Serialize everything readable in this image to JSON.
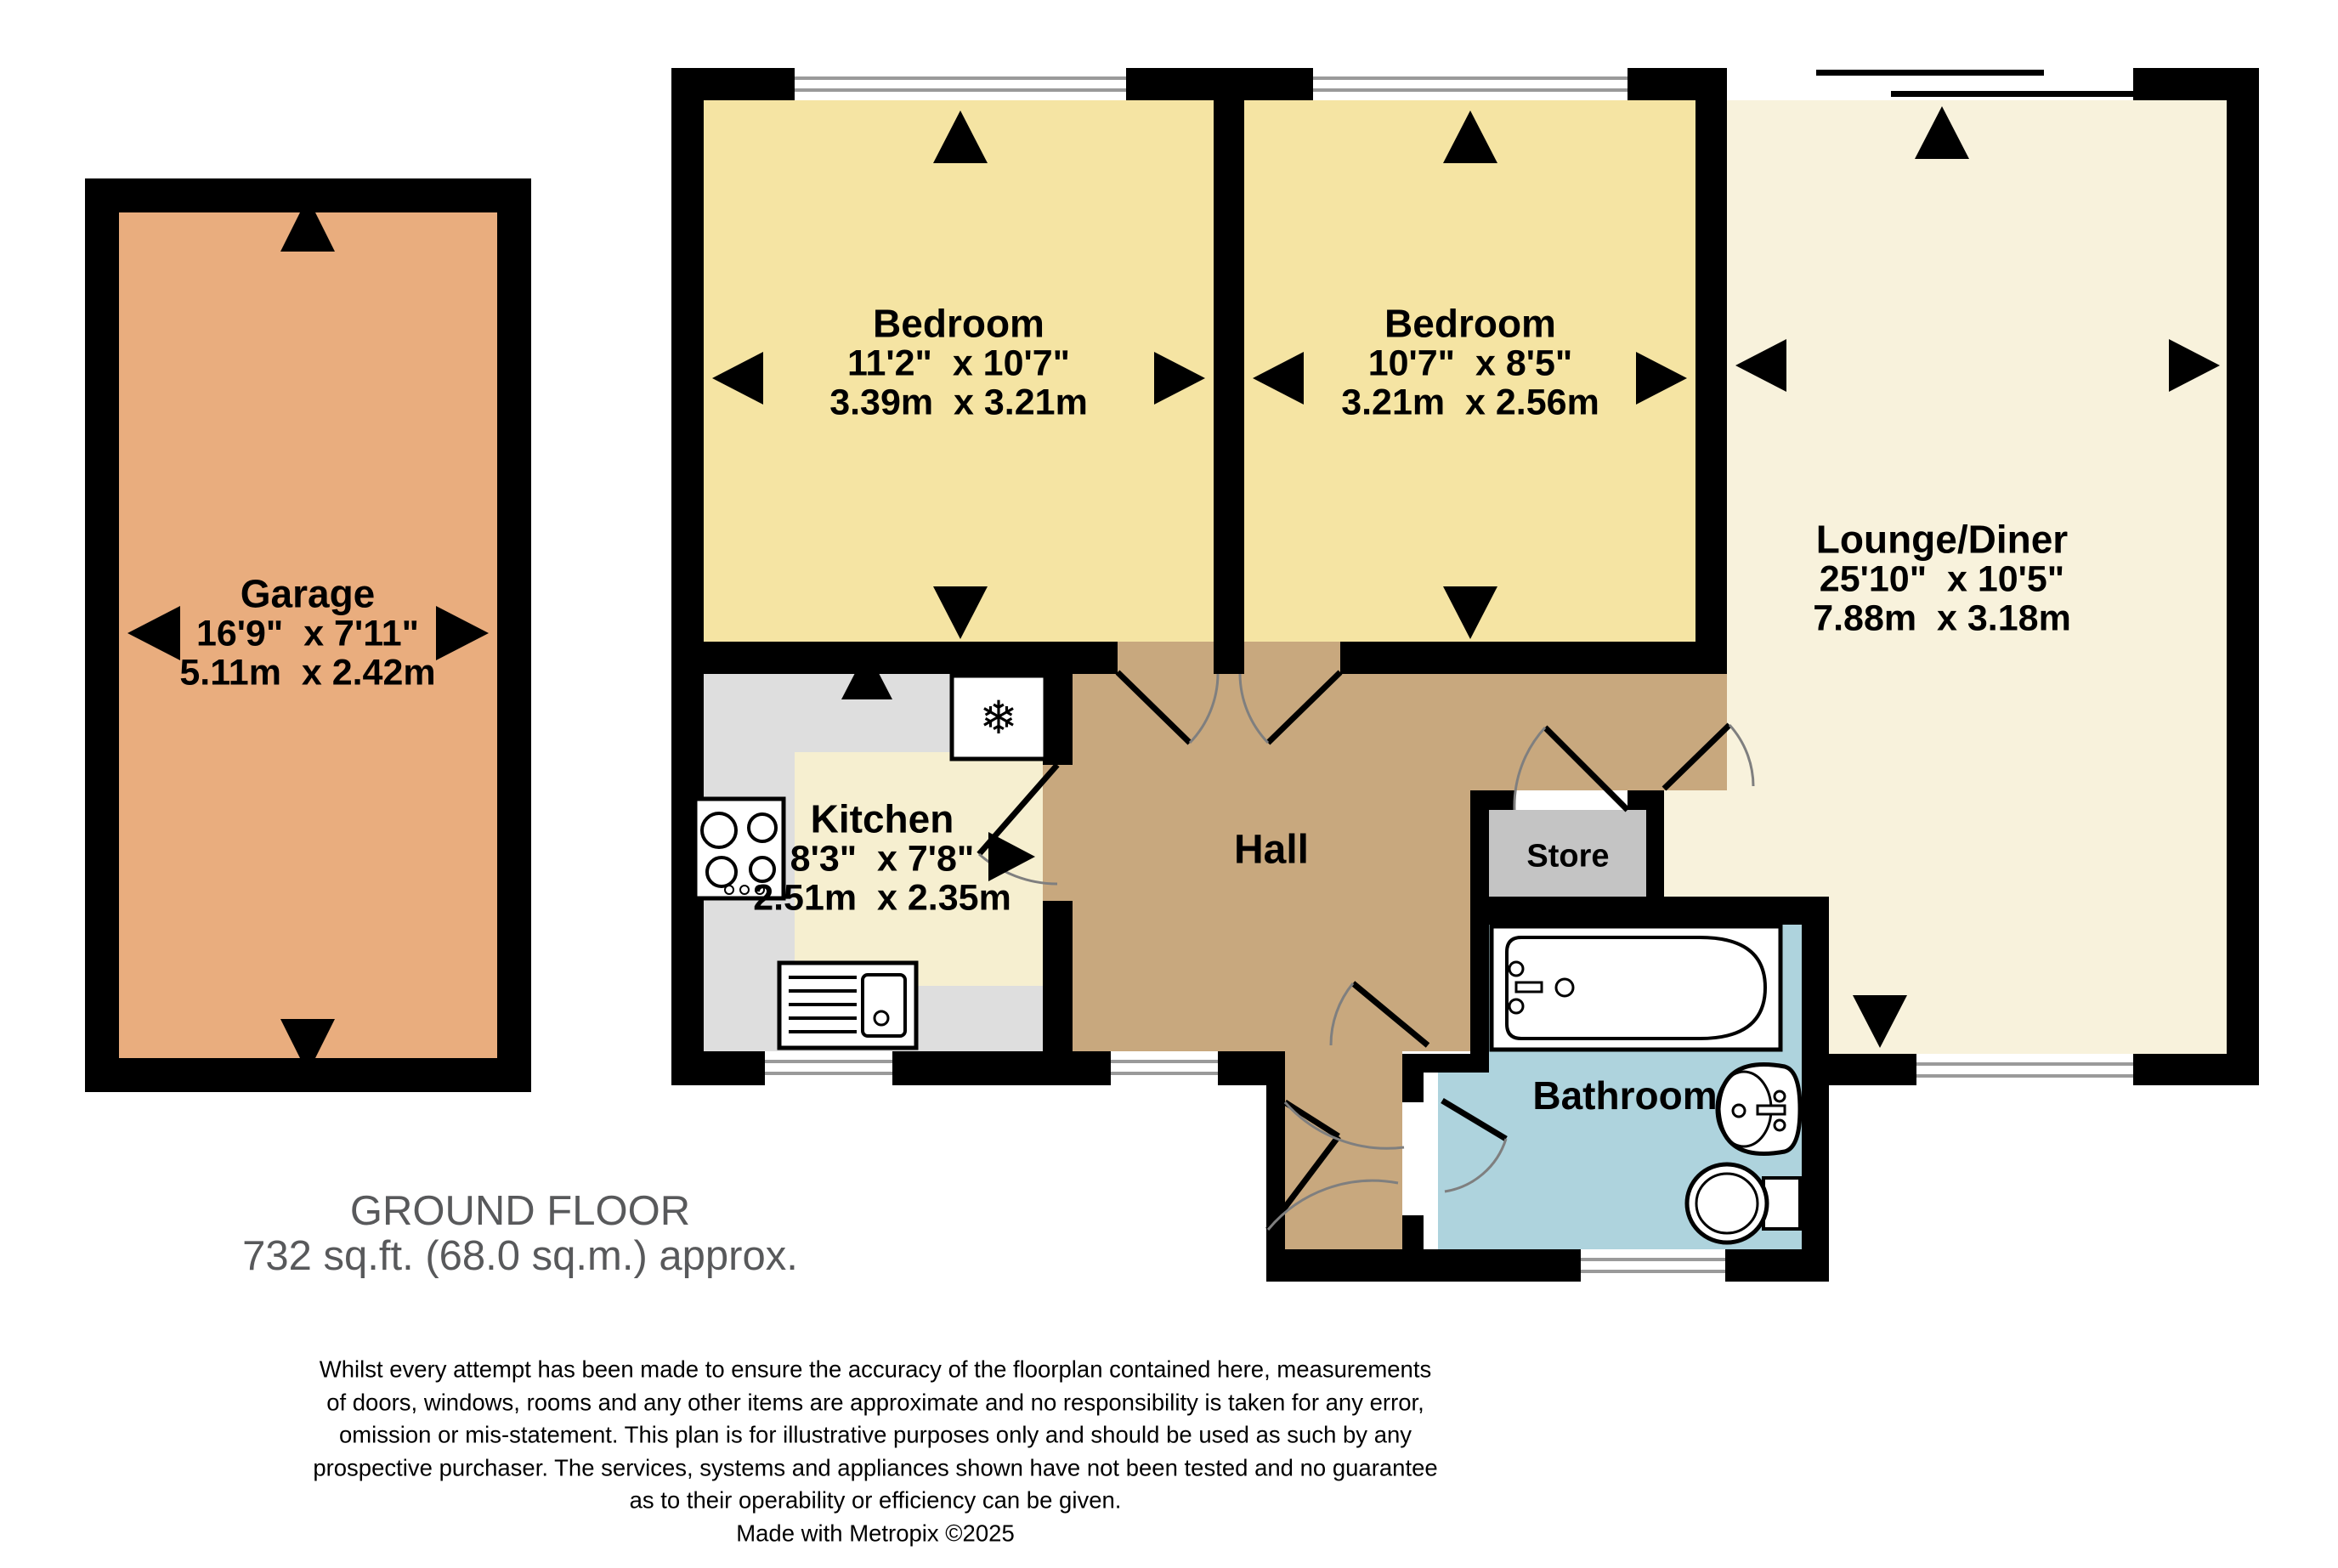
{
  "plan": {
    "floor_title": "GROUND FLOOR",
    "floor_area": "732 sq.ft. (68.0 sq.m.) approx.",
    "rooms": {
      "garage": {
        "name": "Garage",
        "imperial": "16'9\"  x 7'11\"",
        "metric": "5.11m  x 2.42m"
      },
      "bedroom1": {
        "name": "Bedroom",
        "imperial": "11'2\"  x 10'7\"",
        "metric": "3.39m  x 3.21m"
      },
      "bedroom2": {
        "name": "Bedroom",
        "imperial": "10'7\"  x 8'5\"",
        "metric": "3.21m  x 2.56m"
      },
      "lounge": {
        "name": "Lounge/Diner",
        "imperial": "25'10\"  x 10'5\"",
        "metric": "7.88m  x 3.18m"
      },
      "kitchen": {
        "name": "Kitchen",
        "imperial": "8'3\"  x 7'8\"",
        "metric": "2.51m  x 2.35m"
      },
      "hall": {
        "name": "Hall"
      },
      "store": {
        "name": "Store"
      },
      "bathroom": {
        "name": "Bathroom"
      }
    },
    "icons": {
      "fridge_snowflake": "❄"
    },
    "colors": {
      "wall": "#000000",
      "garage": "#E9AD7E",
      "bedroom": "#F5E4A3",
      "lounge": "#F8F2DC",
      "kitchen_floor": "#DEDEDE",
      "kitchen_accent": "#F6EFD0",
      "hall": "#C8A87E",
      "store": "#C4C4C4",
      "bathroom": "#AED3DD",
      "glazing": "#9A9A9A",
      "door_arc": "#7F7F7F",
      "title_text": "#58595B"
    },
    "disclaimer": {
      "lines": [
        "Whilst every attempt has been made to ensure the accuracy of the floorplan contained here, measurements",
        "of doors, windows, rooms and any other items are approximate and no responsibility is taken for any error,",
        "omission or mis-statement. This plan is for illustrative purposes only and should be used as such by any",
        "prospective purchaser. The services, systems and appliances shown have not been tested and no guarantee",
        "as to their operability or efficiency can be given."
      ],
      "credit": "Made with Metropix ©2025"
    }
  }
}
